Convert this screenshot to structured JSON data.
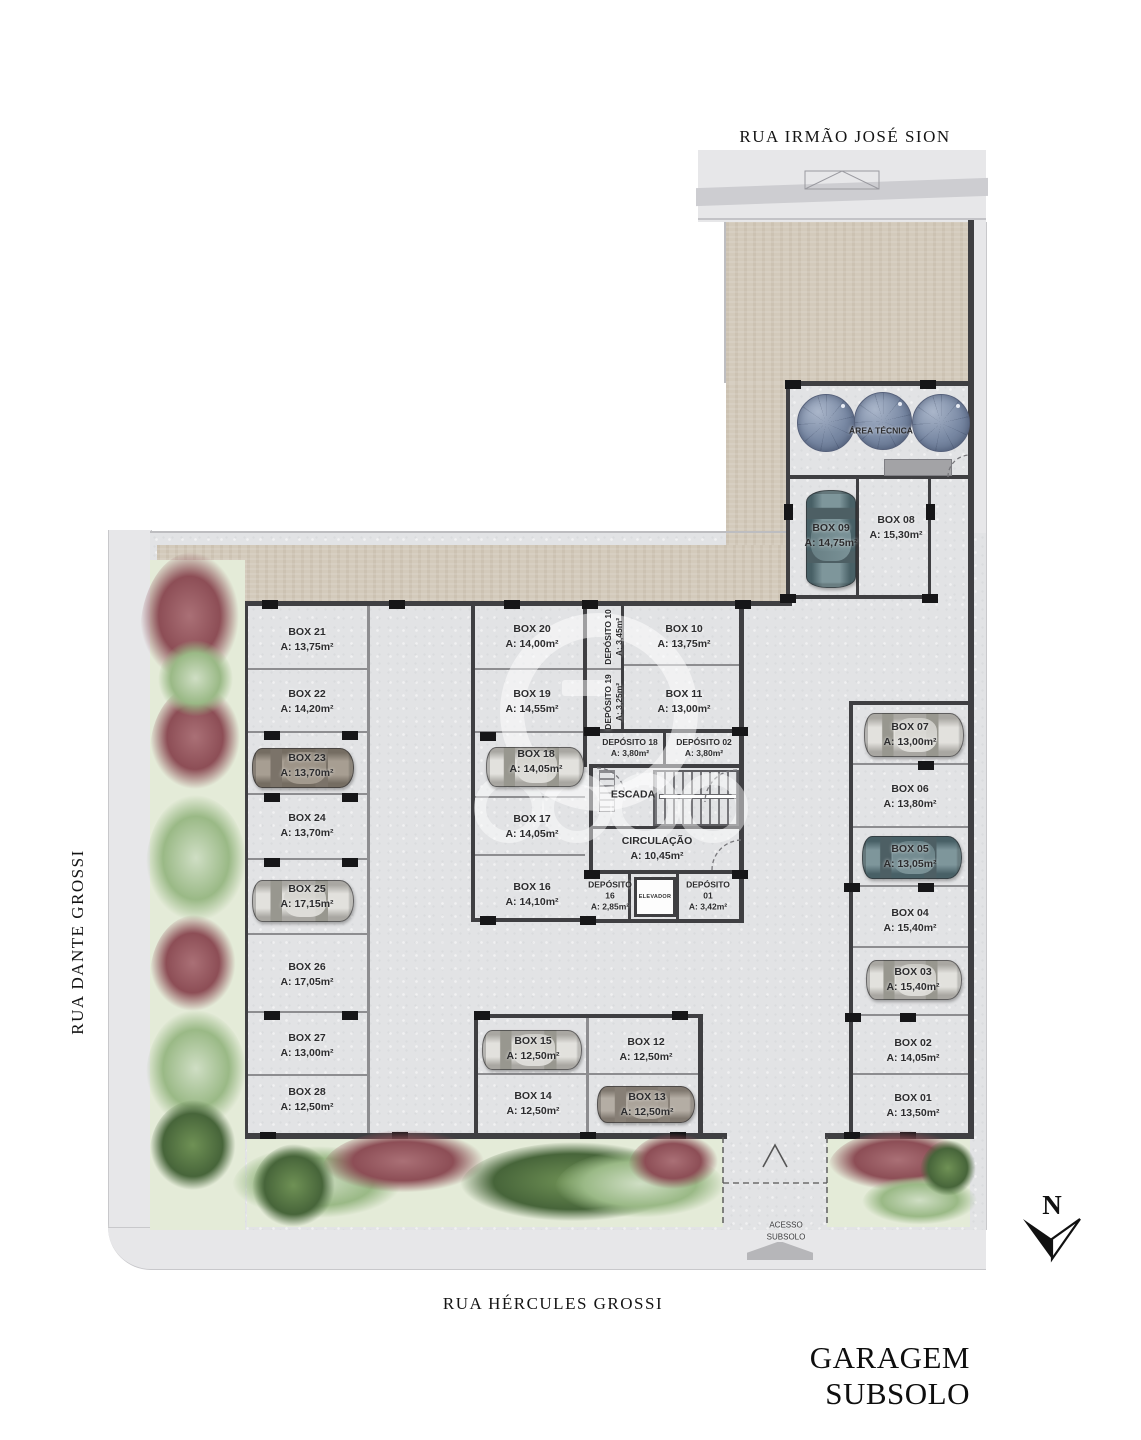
{
  "title": "GARAGEM SUBSOLO",
  "streets": {
    "top": "RUA IRMÃO JOSÉ SION",
    "left": "RUA DANTE GROSSI",
    "bottom": "RUA HÉRCULES GROSSI"
  },
  "compass": {
    "label": "N"
  },
  "access": {
    "line1": "ACESSO",
    "line2": "SUBSOLO"
  },
  "rooms": {
    "area_tecnica": {
      "name": "ÁREA TÉCNICA"
    },
    "escada": {
      "name": "ESCADA"
    },
    "elevador": {
      "name": "ELEVADOR"
    },
    "circulacao": {
      "name": "CIRCULAÇÃO",
      "area": "A: 10,45m²"
    },
    "dep01": {
      "l1": "DEPÓSITO",
      "l2": "01",
      "area": "A: 3,42m²"
    },
    "dep02": {
      "name": "DEPÓSITO 02",
      "area": "A: 3,80m²"
    },
    "dep16": {
      "l1": "DEPÓSITO",
      "l2": "16",
      "area": "A: 2,85m²"
    },
    "dep18": {
      "name": "DEPÓSITO 18",
      "area": "A: 3,80m²"
    },
    "dep10": {
      "name": "DEPÓSITO 10",
      "area": "A: 3,45m²"
    },
    "dep19": {
      "name": "DEPÓSITO 19",
      "area": "A: 3,25m²"
    }
  },
  "boxes": {
    "b01": {
      "name": "BOX 01",
      "area": "A: 13,50m²"
    },
    "b02": {
      "name": "BOX 02",
      "area": "A: 14,05m²"
    },
    "b03": {
      "name": "BOX 03",
      "area": "A: 15,40m²"
    },
    "b04": {
      "name": "BOX 04",
      "area": "A: 15,40m²"
    },
    "b05": {
      "name": "BOX 05",
      "area": "A: 13,05m²"
    },
    "b06": {
      "name": "BOX 06",
      "area": "A: 13,80m²"
    },
    "b07": {
      "name": "BOX 07",
      "area": "A: 13,00m²"
    },
    "b08": {
      "name": "BOX 08",
      "area": "A: 15,30m²"
    },
    "b09": {
      "name": "BOX 09",
      "area": "A: 14,75m²"
    },
    "b10": {
      "name": "BOX 10",
      "area": "A: 13,75m²"
    },
    "b11": {
      "name": "BOX 11",
      "area": "A: 13,00m²"
    },
    "b12": {
      "name": "BOX 12",
      "area": "A: 12,50m²"
    },
    "b13": {
      "name": "BOX 13",
      "area": "A: 12,50m²"
    },
    "b14": {
      "name": "BOX 14",
      "area": "A: 12,50m²"
    },
    "b15": {
      "name": "BOX 15",
      "area": "A: 12,50m²"
    },
    "b16": {
      "name": "BOX 16",
      "area": "A: 14,10m²"
    },
    "b17": {
      "name": "BOX 17",
      "area": "A: 14,05m²"
    },
    "b18": {
      "name": "BOX 18",
      "area": "A: 14,05m²"
    },
    "b19": {
      "name": "BOX 19",
      "area": "A: 14,55m²"
    },
    "b20": {
      "name": "BOX 20",
      "area": "A: 14,00m²"
    },
    "b21": {
      "name": "BOX 21",
      "area": "A: 13,75m²"
    },
    "b22": {
      "name": "BOX 22",
      "area": "A: 14,20m²"
    },
    "b23": {
      "name": "BOX 23",
      "area": "A: 13,70m²"
    },
    "b24": {
      "name": "BOX 24",
      "area": "A: 13,70m²"
    },
    "b25": {
      "name": "BOX 25",
      "area": "A: 17,15m²"
    },
    "b26": {
      "name": "BOX 26",
      "area": "A: 17,05m²"
    },
    "b27": {
      "name": "BOX 27",
      "area": "A: 13,00m²"
    },
    "b28": {
      "name": "BOX 28",
      "area": "A: 12,50m²"
    }
  },
  "palette": {
    "wall": "#3f3f42",
    "partition": "#8d8d90",
    "floor": "#e2e3e5",
    "drive": "#d3cabb",
    "sidewalk": "#e7e7e9",
    "street": "#ffffff",
    "garden": "#e4ebd8",
    "text": "#2c2c2e"
  }
}
